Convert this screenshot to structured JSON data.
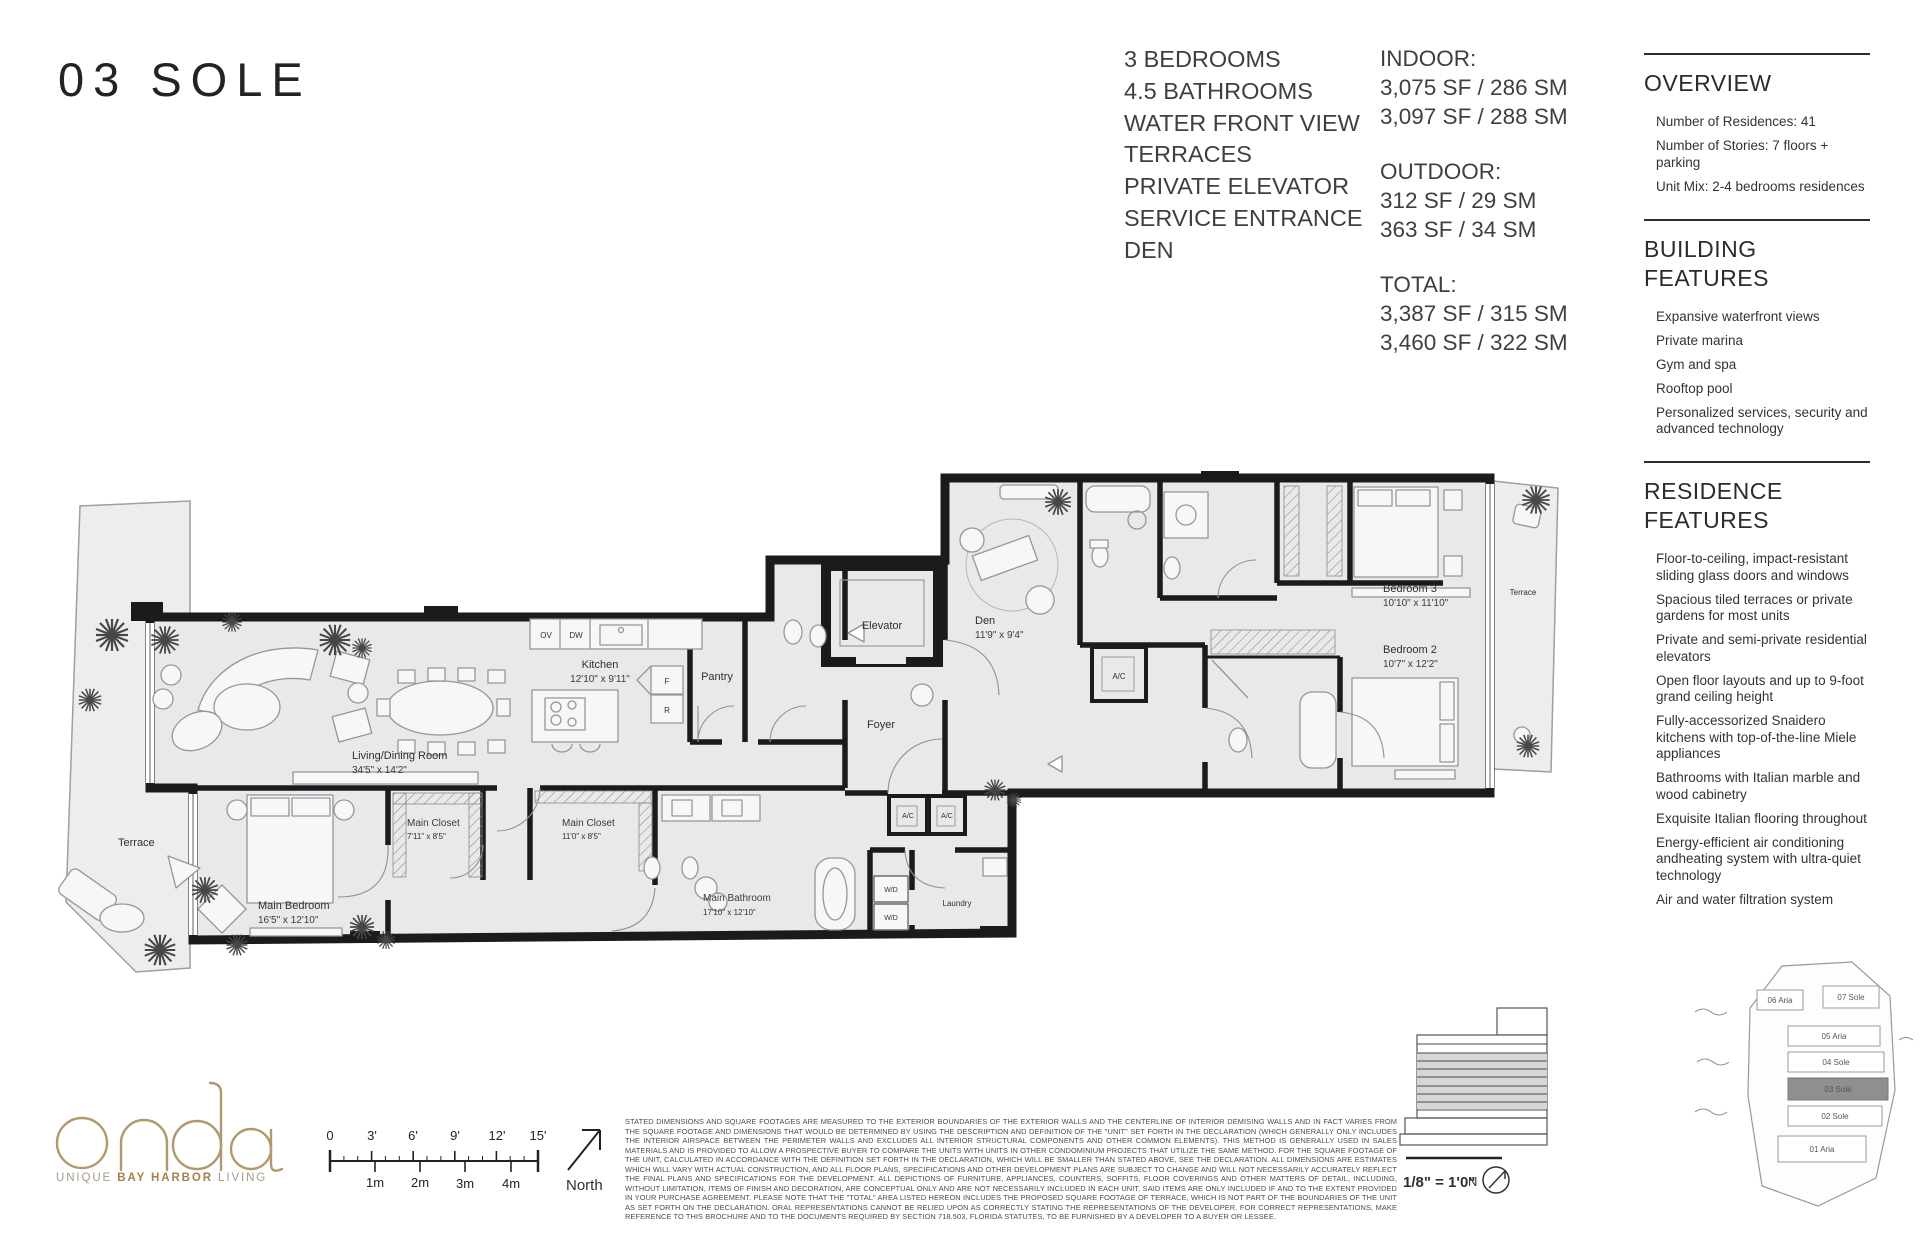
{
  "page": {
    "title": "03 SOLE"
  },
  "features": [
    "3 BEDROOMS",
    "4.5 BATHROOMS",
    "WATER FRONT VIEW",
    "TERRACES",
    "PRIVATE ELEVATOR",
    "SERVICE ENTRANCE",
    "DEN"
  ],
  "areas": {
    "indoor_label": "INDOOR:",
    "indoor_lines": [
      "3,075 SF / 286 SM",
      "3,097 SF / 288 SM"
    ],
    "outdoor_label": "OUTDOOR:",
    "outdoor_lines": [
      "312 SF / 29 SM",
      "363 SF / 34 SM"
    ],
    "total_label": "TOTAL:",
    "total_lines": [
      "3,387 SF / 315 SM",
      "3,460 SF / 322 SM"
    ]
  },
  "overview": {
    "title": "OVERVIEW",
    "items": [
      "Number of Residences: 41",
      "Number of Stories: 7 floors + parking",
      "Unit Mix: 2-4 bedrooms residences"
    ]
  },
  "building_features": {
    "title": "BUILDING\nFEATURES",
    "items": [
      "Expansive waterfront views",
      "Private marina",
      "Gym and spa",
      "Rooftop pool",
      "Personalized services, security and advanced technology"
    ]
  },
  "residence_features": {
    "title": "RESIDENCE FEATURES",
    "items": [
      "Floor-to-ceiling, impact-resistant sliding glass doors and windows",
      "Spacious tiled terraces or private gardens for most units",
      "Private and semi-private residential elevators",
      "Open floor layouts and up to 9-foot grand ceiling height",
      "Fully-accessorized Snaidero kitchens with top-of-the-line Miele appliances",
      "Bathrooms with Italian marble and wood cabinetry",
      "Exquisite Italian flooring throughout",
      "Energy-efficient air conditioning andheating system with ultra-quiet technology",
      "Air and water filtration system"
    ]
  },
  "floorplan": {
    "rooms": {
      "living": {
        "name": "Living/Dining Room",
        "dims": "34'5\" x 14'2\""
      },
      "kitchen": {
        "name": "Kitchen",
        "dims": "12'10\" x 9'11\""
      },
      "pantry": {
        "name": "Pantry"
      },
      "elevator": {
        "name": "Elevator"
      },
      "foyer": {
        "name": "Foyer"
      },
      "den": {
        "name": "Den",
        "dims": "11'9\" x 9'4\""
      },
      "bedroom3": {
        "name": "Bedroom 3",
        "dims": "10'10\" x 11'10\""
      },
      "bedroom2": {
        "name": "Bedroom 2",
        "dims": "10'7\" x 12'2\""
      },
      "main_bedroom": {
        "name": "Main Bedroom",
        "dims": "16'5\" x 12'10\""
      },
      "main_closet_1": {
        "name": "Main Closet",
        "dims": "7'11\" x 8'5\""
      },
      "main_closet_2": {
        "name": "Main Closet",
        "dims": "11'0\" x 8'5\""
      },
      "main_bathroom": {
        "name": "Main Bathroom",
        "dims": "17'10\" x 12'10\""
      },
      "laundry": {
        "name": "Laundry"
      },
      "terrace_left": {
        "name": "Terrace"
      },
      "terrace_right": {
        "name": "Terrace"
      }
    },
    "appliances": {
      "ov": "OV",
      "dw": "DW",
      "f": "F",
      "r": "R",
      "wd": "W/D",
      "ac": "A/C"
    }
  },
  "scale_bar": {
    "feet": [
      "0",
      "3'",
      "6'",
      "9'",
      "12'",
      "15'"
    ],
    "meters": [
      "1m",
      "2m",
      "3m",
      "4m"
    ]
  },
  "north": {
    "label": "North"
  },
  "logo": {
    "name": "onda",
    "tagline": [
      "UNIQUE",
      "BAY HARBOR",
      "LIVING"
    ],
    "accent_color": "#b2996d"
  },
  "key_plan": {
    "units": [
      "06 Aria",
      "07 Sole",
      "05 Aria",
      "04 Sole",
      "03 Sole",
      "02 Sole",
      "01 Aria"
    ],
    "highlighted_unit": "03 Sole",
    "scale_note": "1/8\" = 1'0\"",
    "north_abbr": "N"
  },
  "disclaimer": "STATED DIMENSIONS AND SQUARE FOOTAGES ARE MEASURED TO THE EXTERIOR BOUNDARIES OF THE EXTERIOR WALLS AND THE CENTERLINE OF INTERIOR DEMISING WALLS AND IN FACT VARIES FROM THE SQUARE FOOTAGE AND DIMENSIONS THAT WOULD BE DETERMINED BY USING THE DESCRIPTION AND DEFINITION OF THE \"UNIT\" SET FORTH IN THE DECLARATION (WHICH GENERALLY ONLY INCLUDES THE INTERIOR AIRSPACE BETWEEN THE PERIMETER WALLS AND EXCLUDES ALL INTERIOR STRUCTURAL COMPONENTS AND OTHER COMMON ELEMENTS). THIS METHOD IS GENERALLY USED IN SALES MATERIALS AND IS PROVIDED TO ALLOW A PROSPECTIVE BUYER TO COMPARE THE UNITS WITH UNITS IN OTHER CONDOMINIUM PROJECTS THAT UTILIZE THE SAME METHOD. FOR THE SQUARE FOOTAGE OF THE UNIT, CALCULATED IN ACCORDANCE WITH THE DEFINITION SET FORTH IN THE DECLARATION, WHICH WILL BE SMALLER THAN STATED ABOVE, SEE THE DECLARATION. ALL DIMENSIONS ARE ESTIMATES WHICH WILL VARY WITH ACTUAL CONSTRUCTION, AND ALL FLOOR PLANS, SPECIFICATIONS AND OTHER DEVELOPMENT PLANS ARE SUBJECT TO CHANGE AND WILL NOT NECESSARILY ACCURATELY REFLECT THE FINAL PLANS AND SPECIFICATIONS FOR THE DEVELOPMENT. ALL DEPICTIONS OF FURNITURE, APPLIANCES, COUNTERS, SOFFITS, FLOOR COVERINGS AND OTHER MATTERS OF DETAIL, INCLUDING, WITHOUT LIMITATION, ITEMS OF FINISH AND DECORATION, ARE CONCEPTUAL ONLY AND ARE NOT NECESSARILY INCLUDED IN EACH UNIT. SAID ITEMS ARE ONLY INCLUDED IF AND TO THE EXTENT PROVIDED IN YOUR PURCHASE AGREEMENT. PLEASE NOTE THAT THE \"TOTAL\" AREA LISTED HEREON INCLUDES THE PROPOSED SQUARE FOOTAGE OF TERRACE, WHICH IS NOT PART OF THE BOUNDARIES OF THE UNIT AS SET FORTH ON THE DECLARATION. ORAL REPRESENTATIONS CANNOT BE RELIED UPON AS CORRECTLY STATING THE REPRESENTATIONS OF THE DEVELOPER. FOR CORRECT REPRESENTATIONS, MAKE REFERENCE TO THIS BROCHURE AND TO THE DOCUMENTS REQUIRED BY SECTION 718.503, FLORIDA STATUTES, TO BE FURNISHED BY A DEVELOPER TO A BUYER OR LESSEE."
}
